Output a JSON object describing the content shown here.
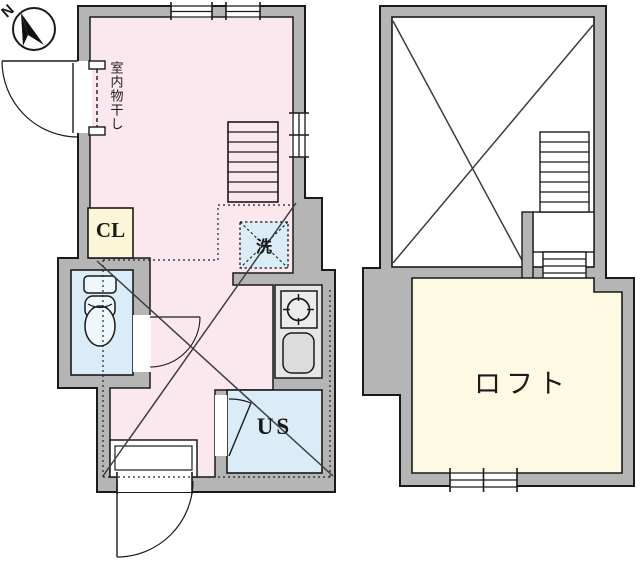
{
  "compass": {
    "north_label": "N"
  },
  "colors": {
    "wall": "#b5b5b5",
    "line": "#1a1a1a",
    "room_pink": "#fbe8ef",
    "water_blue": "#daecf7",
    "closet_cream": "#fcf5d8",
    "loft_cream": "#fdf9e3",
    "counter_gray": "#e6e6e6",
    "fixture_fill": "#eef7fc",
    "diagonal": "#3d3d3d"
  },
  "floor1": {
    "labels": {
      "indoor_drying": "室内物干し",
      "closet": "CL",
      "washing_machine": "洗",
      "unit_shower": "US"
    }
  },
  "floor2": {
    "labels": {
      "loft": "ロフト"
    }
  }
}
